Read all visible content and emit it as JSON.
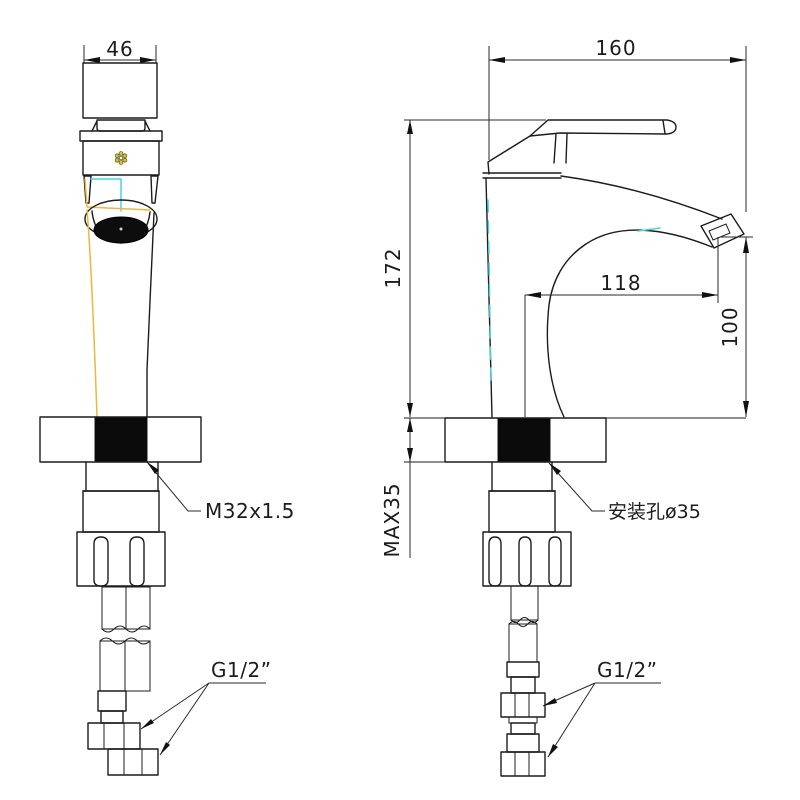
{
  "drawing_title": "basin faucet installation dimension drawing",
  "colors": {
    "line": "#1c1c1c",
    "accent_cyan": "#45d5e6",
    "accent_yellow": "#e9b93d",
    "hole_fill": "#0a0a0a",
    "background": "#ffffff"
  },
  "front_view": {
    "name": "front view",
    "dim_width": "46",
    "thread_label": "M32x1.5",
    "hose_label": "G1/2”"
  },
  "side_view": {
    "name": "side view",
    "dim_overall_width": "160",
    "dim_height": "172",
    "dim_spout_reach": "118",
    "dim_spout_height": "100",
    "dim_deck_thickness": "MAX35",
    "hole_label": "安装孔ø35",
    "hose_label": "G1/2”"
  }
}
